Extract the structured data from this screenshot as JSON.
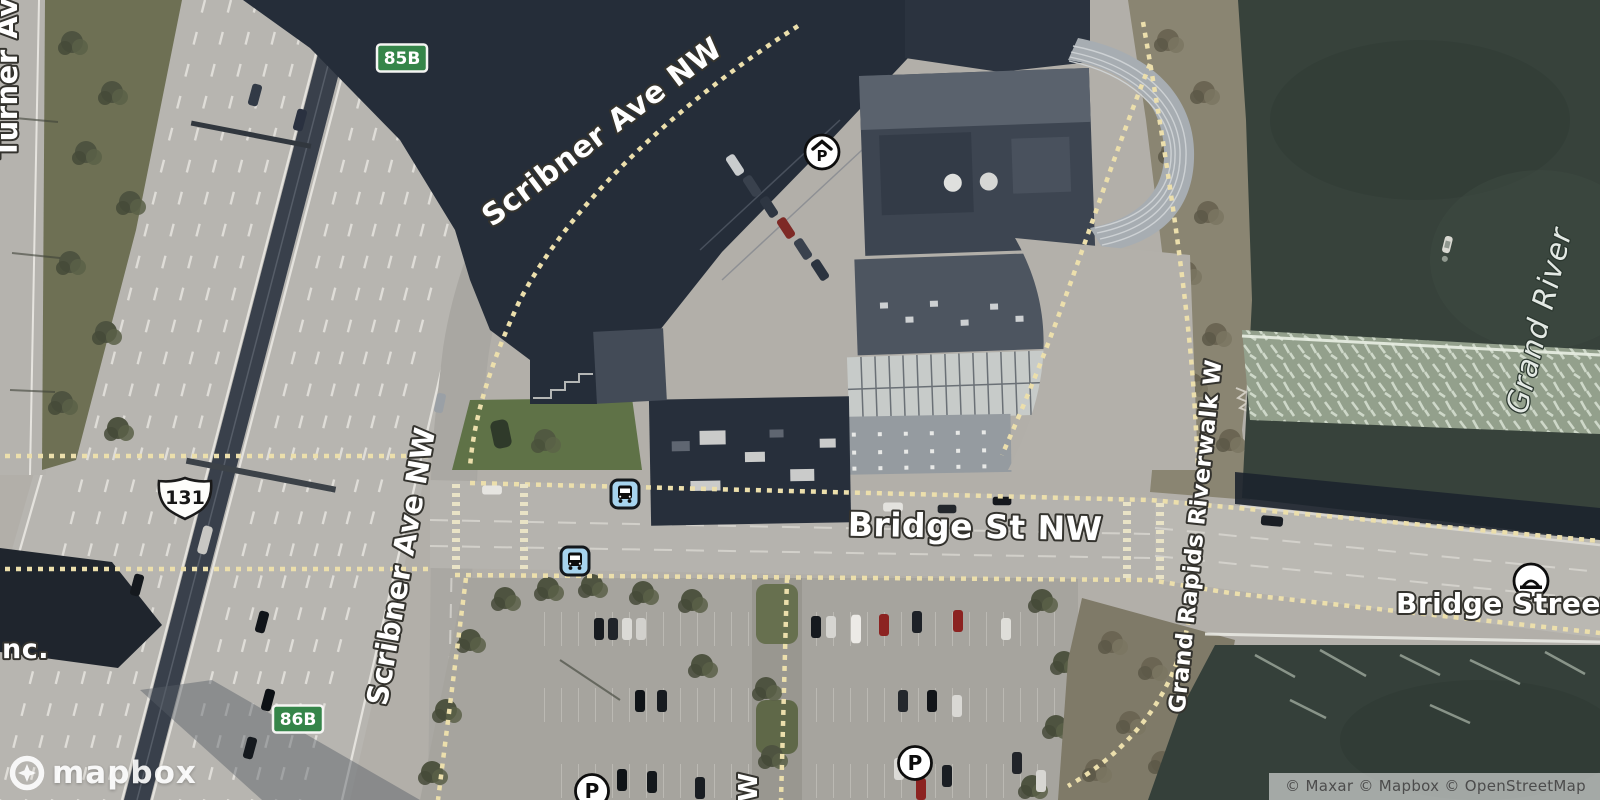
{
  "labels": {
    "turner_ave": "Turner Av",
    "scribner_ave_top": "Scribner Ave NW",
    "scribner_ave_side": "Scribner Ave NW",
    "bridge_st": "Bridge St NW",
    "riverwalk": "Grand Rapids Riverwalk W",
    "grand_river": "Grand River",
    "bridge_street_bridge": "Bridge Street Bri",
    "street_w_partial": "W",
    "poi_nc_partial": "nc."
  },
  "shields": {
    "us_route": "131",
    "exit_85b": "85B",
    "exit_86b": "86B"
  },
  "markers": {
    "parking_letter": "P",
    "covered_parking_letter": "P",
    "icon_names": [
      "bus-stop-icon",
      "parking-icon",
      "covered-parking-icon",
      "bridge-poi-icon"
    ]
  },
  "branding": {
    "logo": "mapbox"
  },
  "attribution": {
    "text": "© Maxar © Mapbox © OpenStreetMap"
  },
  "colors": {
    "water": "#37423b",
    "shadow": "#252d39",
    "road": "#b7b5b0",
    "path_dash": "#ecdfac",
    "shield_green": "#358549",
    "bus_icon_bg": "#a7d4ee",
    "grass": "#6e7054"
  }
}
